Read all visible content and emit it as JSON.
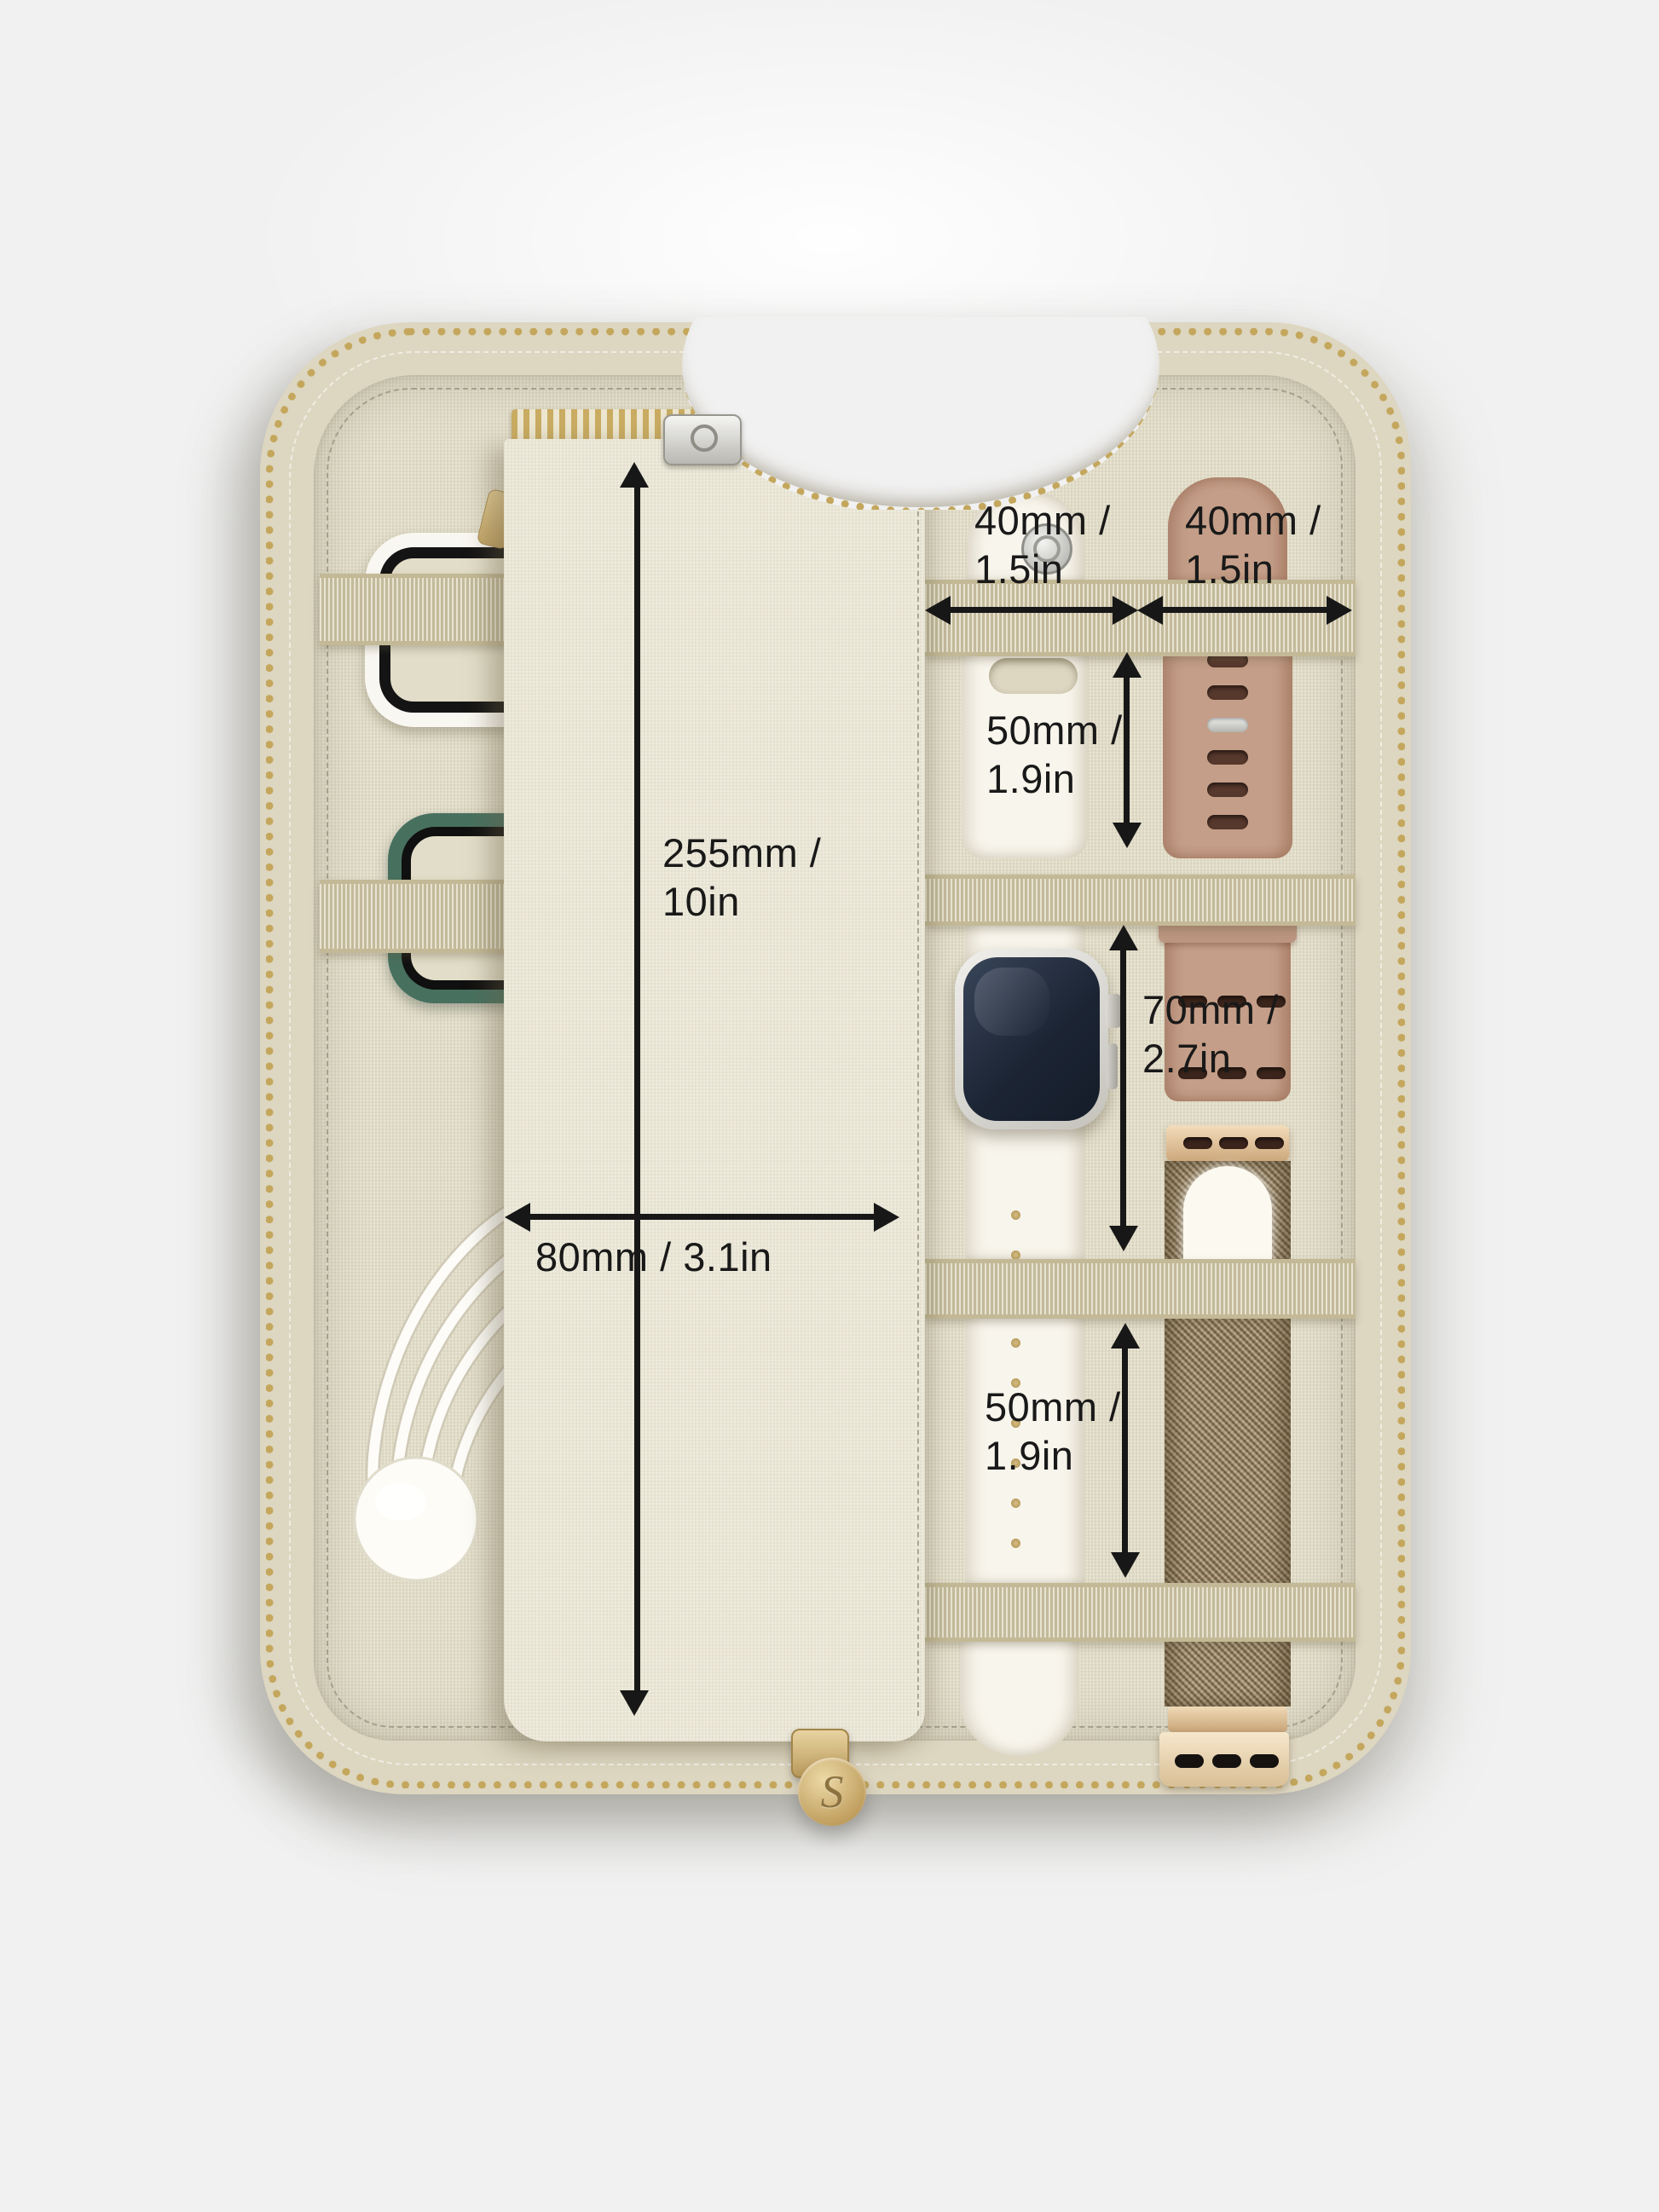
{
  "annotations": {
    "pouch_height": {
      "line1": "255mm /",
      "line2": "10in"
    },
    "pouch_width": {
      "text": "80mm / 3.1in"
    },
    "slot_left_width": {
      "line1": "40mm /",
      "line2": "1.5in"
    },
    "slot_right_width": {
      "line1": "40mm /",
      "line2": "1.5in"
    },
    "gap_top_height": {
      "line1": "50mm /",
      "line2": "1.9in"
    },
    "gap_middle_height": {
      "line1": "70mm /",
      "line2": "2.7in"
    },
    "gap_bottom_height": {
      "line1": "50mm /",
      "line2": "1.9in"
    }
  },
  "charm": {
    "monogram": "S"
  },
  "colors": {
    "background": "#f1f1f1",
    "case_linen_rim": "#ddd6c0",
    "interior_linen": "#e6e1cd",
    "flap_linen": "#edeada",
    "elastic_strap": "#d7cfb0",
    "zipper_gold": "#c4a75d",
    "annotation_black": "#171717",
    "white_sport_band": "#f8f5ec",
    "tan_sport_band": "#c49e88",
    "milanese_bronze": "#93805f",
    "watch_screen_navy": "#1c2534",
    "green_bumper_case": "#47705f",
    "charm_gold": "#c3a263"
  }
}
